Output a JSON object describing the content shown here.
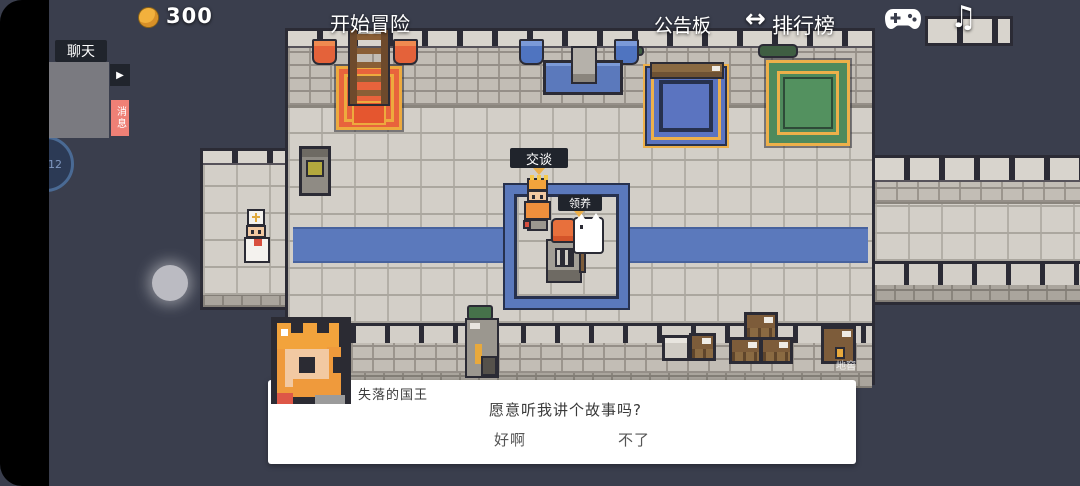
{
  "topbar": {
    "coins": "300",
    "adventure": "开始冒险",
    "board": "公告板",
    "ranking": "排行榜",
    "ranking_arrow": "↔",
    "music_icon": "♫"
  },
  "chat": {
    "title": "聊天",
    "play_icon": "▶",
    "messages_tab": "消息"
  },
  "clock": {
    "time": "12"
  },
  "map": {
    "talk_label": "交谈",
    "adopt_label": "领养",
    "cellar_label": "地窖"
  },
  "dialog": {
    "speaker": "失落的国王",
    "text": "愿意听我讲个故事吗?",
    "options": [
      {
        "label": "好啊"
      },
      {
        "label": "不了"
      }
    ]
  },
  "colors": {
    "accent_blue": "#5b79bc",
    "accent_gold": "#edb04a",
    "accent_orange": "#e8633c",
    "accent_green": "#4f8a5c",
    "coin_gold": "#f2b13d",
    "messages_tab_pink": "#ef8076"
  }
}
